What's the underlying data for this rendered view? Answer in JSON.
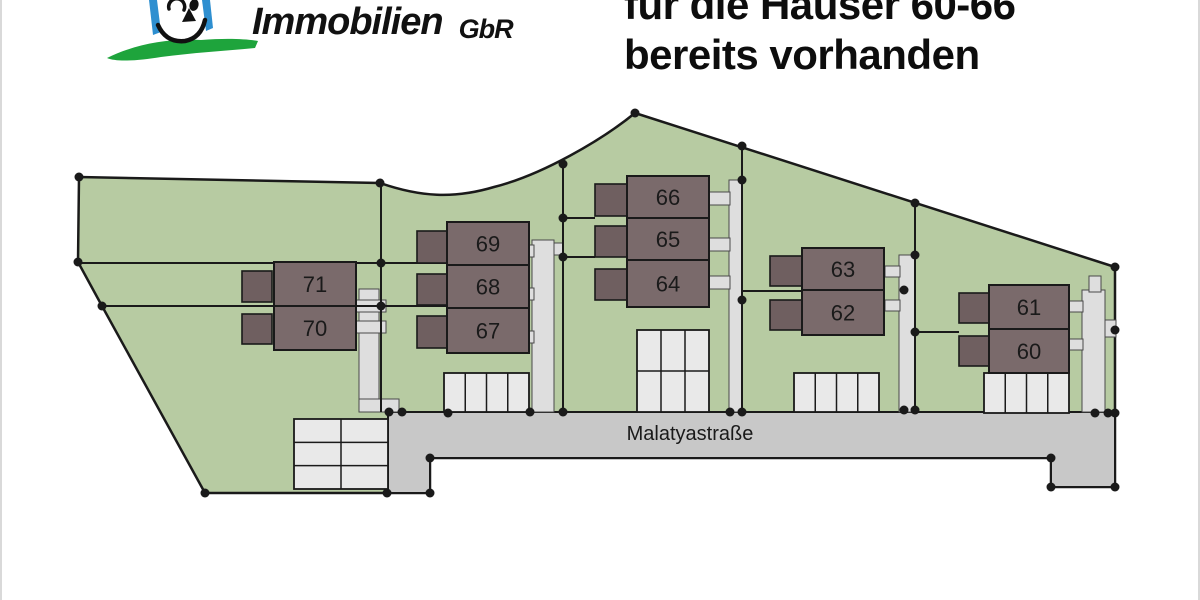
{
  "logo": {
    "brand": "Immobilien",
    "suffix": "GbR"
  },
  "headline": {
    "line1": "für die Häuser 60-66",
    "line2": "bereits vorhanden"
  },
  "plan": {
    "street_label": "Malatyastraße",
    "street_label_pos": [
      688,
      440
    ],
    "colors": {
      "green": "#b7cba2",
      "street": "#c8c8c8",
      "path": "#dedede",
      "stall": "#e9e9e9",
      "house": "#7a6a6b",
      "annex": "#6f5f60",
      "line": "#1a1a1a"
    },
    "site_path": "M77,177 L378,183 C418,197 452,199 492,187 C540,175 600,140 633,113 L1113,267 L1113,487 L1049,487 L1049,458 L428,458 L428,493 L203,493 L100,306 L76,262 Z",
    "street_points": "386,412 1113,412 1113,487 1049,487 1049,458 428,458 428,493 386,493",
    "footpaths": [
      {
        "name": "footpath-houses-70-71",
        "rects": [
          [
            357,
            289,
            20,
            123
          ],
          [
            353,
            300,
            31,
            12
          ],
          [
            353,
            321,
            31,
            12
          ],
          [
            357,
            399,
            40,
            13
          ]
        ]
      },
      {
        "name": "footpath-houses-67-69",
        "rects": [
          [
            530,
            240,
            22,
            172
          ],
          [
            525,
            245,
            7,
            12
          ],
          [
            525,
            288,
            7,
            12
          ],
          [
            525,
            331,
            7,
            12
          ],
          [
            552,
            243,
            9,
            12
          ]
        ]
      },
      {
        "name": "footpath-houses-64-66",
        "rects": [
          [
            727,
            180,
            13,
            232
          ],
          [
            707,
            192,
            21,
            13
          ],
          [
            707,
            238,
            21,
            13
          ],
          [
            707,
            276,
            21,
            13
          ]
        ]
      },
      {
        "name": "footpath-houses-62-63",
        "rects": [
          [
            897,
            255,
            16,
            157
          ],
          [
            883,
            266,
            15,
            11
          ],
          [
            883,
            300,
            15,
            11
          ]
        ]
      },
      {
        "name": "footpath-houses-60-61",
        "rects": [
          [
            1080,
            290,
            23,
            122
          ],
          [
            1087,
            276,
            12,
            16
          ],
          [
            1067,
            301,
            14,
            11
          ],
          [
            1067,
            339,
            14,
            11
          ],
          [
            1103,
            320,
            11,
            17
          ]
        ]
      }
    ],
    "division_lines": [
      [
        76,
        263,
        445,
        263
      ],
      [
        100,
        306,
        445,
        306
      ],
      [
        379,
        183,
        379,
        412
      ],
      [
        561,
        164,
        561,
        412
      ],
      [
        561,
        218,
        593,
        218
      ],
      [
        561,
        257,
        593,
        257
      ],
      [
        740,
        146,
        740,
        412
      ],
      [
        740,
        291,
        800,
        291
      ],
      [
        913,
        203,
        913,
        412
      ],
      [
        913,
        332,
        957,
        332
      ]
    ],
    "parking": [
      {
        "name": "parking-grid-west",
        "x": 292,
        "y": 419,
        "w": 94,
        "h": 70,
        "cols": 2,
        "rows": 3
      },
      {
        "name": "parking-houses-67-69",
        "x": 442,
        "y": 373,
        "w": 85,
        "h": 39,
        "cols": 4,
        "rows": 1
      },
      {
        "name": "parking-houses-64-66",
        "x": 635,
        "y": 330,
        "w": 72,
        "h": 82,
        "cols": 3,
        "rows": 2
      },
      {
        "name": "parking-houses-62-63",
        "x": 792,
        "y": 373,
        "w": 85,
        "h": 39,
        "cols": 4,
        "rows": 1
      },
      {
        "name": "parking-houses-60-61",
        "x": 982,
        "y": 373,
        "w": 85,
        "h": 40,
        "cols": 4,
        "rows": 1
      }
    ],
    "houses": [
      {
        "label": "71",
        "main": [
          272,
          262,
          82,
          44
        ],
        "annex": [
          240,
          271,
          30,
          31
        ]
      },
      {
        "label": "70",
        "main": [
          272,
          306,
          82,
          44
        ],
        "annex": [
          240,
          314,
          30,
          30
        ]
      },
      {
        "label": "69",
        "main": [
          445,
          222,
          82,
          43
        ],
        "annex": [
          415,
          231,
          30,
          32
        ]
      },
      {
        "label": "68",
        "main": [
          445,
          265,
          82,
          43
        ],
        "annex": [
          415,
          274,
          30,
          31
        ]
      },
      {
        "label": "67",
        "main": [
          445,
          308,
          82,
          45
        ],
        "annex": [
          415,
          316,
          30,
          32
        ]
      },
      {
        "label": "66",
        "main": [
          625,
          176,
          82,
          42
        ],
        "annex": [
          593,
          184,
          32,
          32
        ]
      },
      {
        "label": "65",
        "main": [
          625,
          218,
          82,
          42
        ],
        "annex": [
          593,
          226,
          32,
          31
        ]
      },
      {
        "label": "64",
        "main": [
          625,
          260,
          82,
          47
        ],
        "annex": [
          593,
          269,
          32,
          31
        ]
      },
      {
        "label": "63",
        "main": [
          800,
          248,
          82,
          42
        ],
        "annex": [
          768,
          256,
          32,
          30
        ]
      },
      {
        "label": "62",
        "main": [
          800,
          290,
          82,
          45
        ],
        "annex": [
          768,
          300,
          32,
          30
        ]
      },
      {
        "label": "61",
        "main": [
          987,
          285,
          80,
          44
        ],
        "annex": [
          957,
          293,
          30,
          30
        ]
      },
      {
        "label": "60",
        "main": [
          987,
          329,
          80,
          44
        ],
        "annex": [
          957,
          336,
          30,
          30
        ]
      }
    ],
    "dots": [
      [
        77,
        177
      ],
      [
        76,
        262
      ],
      [
        100,
        306
      ],
      [
        203,
        493
      ],
      [
        385,
        493
      ],
      [
        428,
        493
      ],
      [
        428,
        458
      ],
      [
        1049,
        458
      ],
      [
        1049,
        487
      ],
      [
        1113,
        487
      ],
      [
        1113,
        413
      ],
      [
        1113,
        330
      ],
      [
        1113,
        267
      ],
      [
        913,
        203
      ],
      [
        740,
        146
      ],
      [
        633,
        113
      ],
      [
        561,
        164
      ],
      [
        378,
        183
      ],
      [
        379,
        263
      ],
      [
        379,
        306
      ],
      [
        387,
        412
      ],
      [
        400,
        412
      ],
      [
        446,
        413
      ],
      [
        528,
        412
      ],
      [
        561,
        412
      ],
      [
        561,
        218
      ],
      [
        561,
        257
      ],
      [
        740,
        180
      ],
      [
        740,
        300
      ],
      [
        728,
        412
      ],
      [
        740,
        412
      ],
      [
        913,
        255
      ],
      [
        913,
        332
      ],
      [
        902,
        410
      ],
      [
        913,
        410
      ],
      [
        902,
        290
      ],
      [
        1093,
        413
      ],
      [
        1106,
        413
      ]
    ]
  }
}
